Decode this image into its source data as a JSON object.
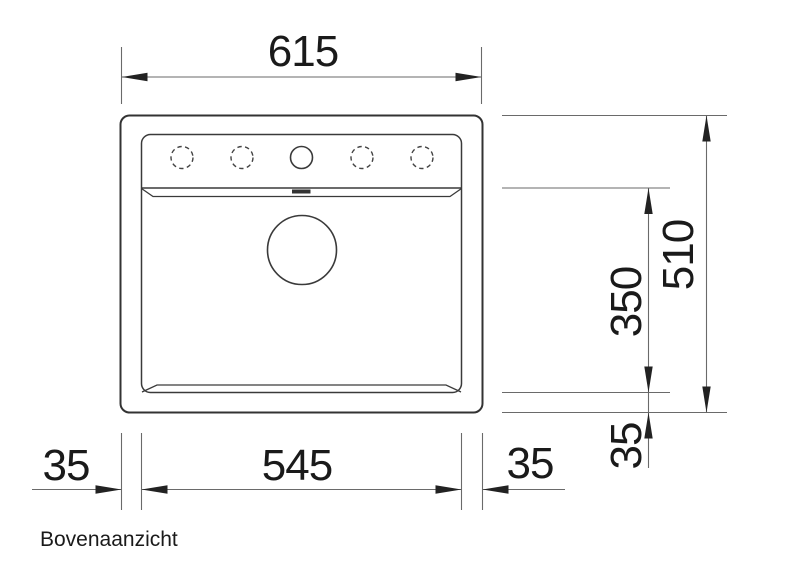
{
  "drawing": {
    "caption": "Bovenaanzicht",
    "dimensions": {
      "overall_width": "615",
      "overall_depth": "510",
      "bowl_depth": "350",
      "bowl_width": "545",
      "left_margin": "35",
      "right_margin": "35",
      "front_margin": "35"
    }
  },
  "colors": {
    "background": "#ffffff",
    "outline": "#333333",
    "dimension_lines": "#6a6a6a",
    "text": "#1a1a1a"
  }
}
